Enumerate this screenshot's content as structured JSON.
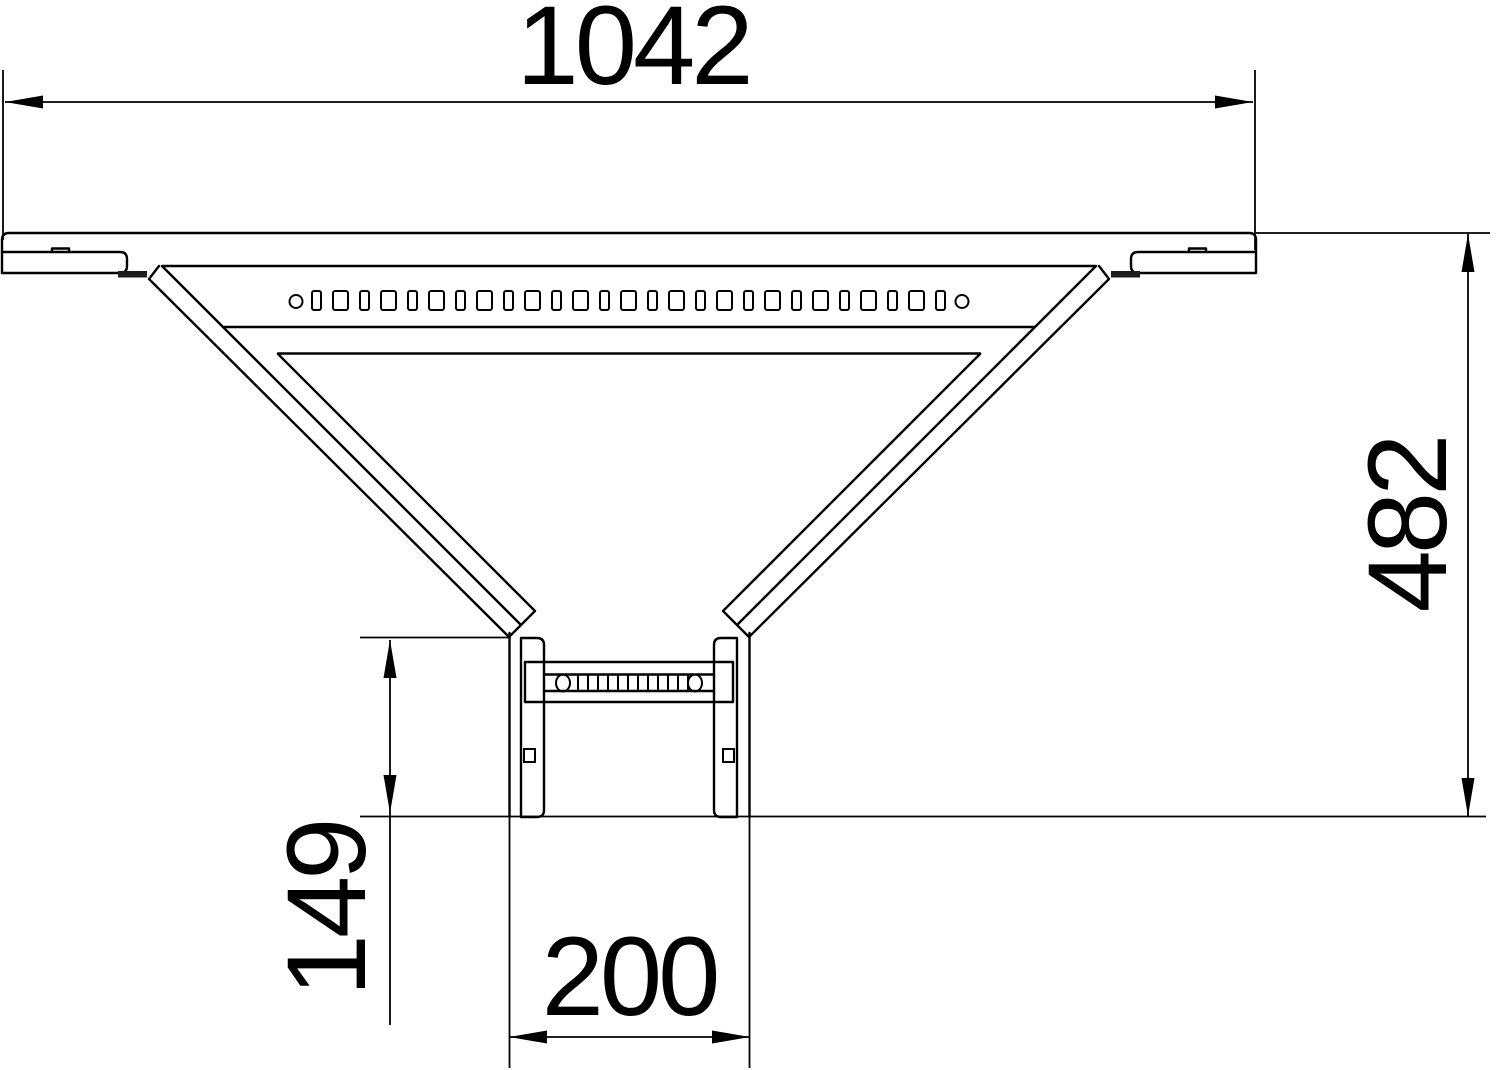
{
  "dimensions": {
    "overall_width": {
      "label": "1042"
    },
    "overall_height": {
      "label": "482"
    },
    "branch_stub_height": {
      "label": "149"
    },
    "branch_width": {
      "label": "200"
    }
  },
  "colors": {
    "line": "#000000",
    "background": "#ffffff",
    "connector_fill": "#1c1c1c"
  }
}
